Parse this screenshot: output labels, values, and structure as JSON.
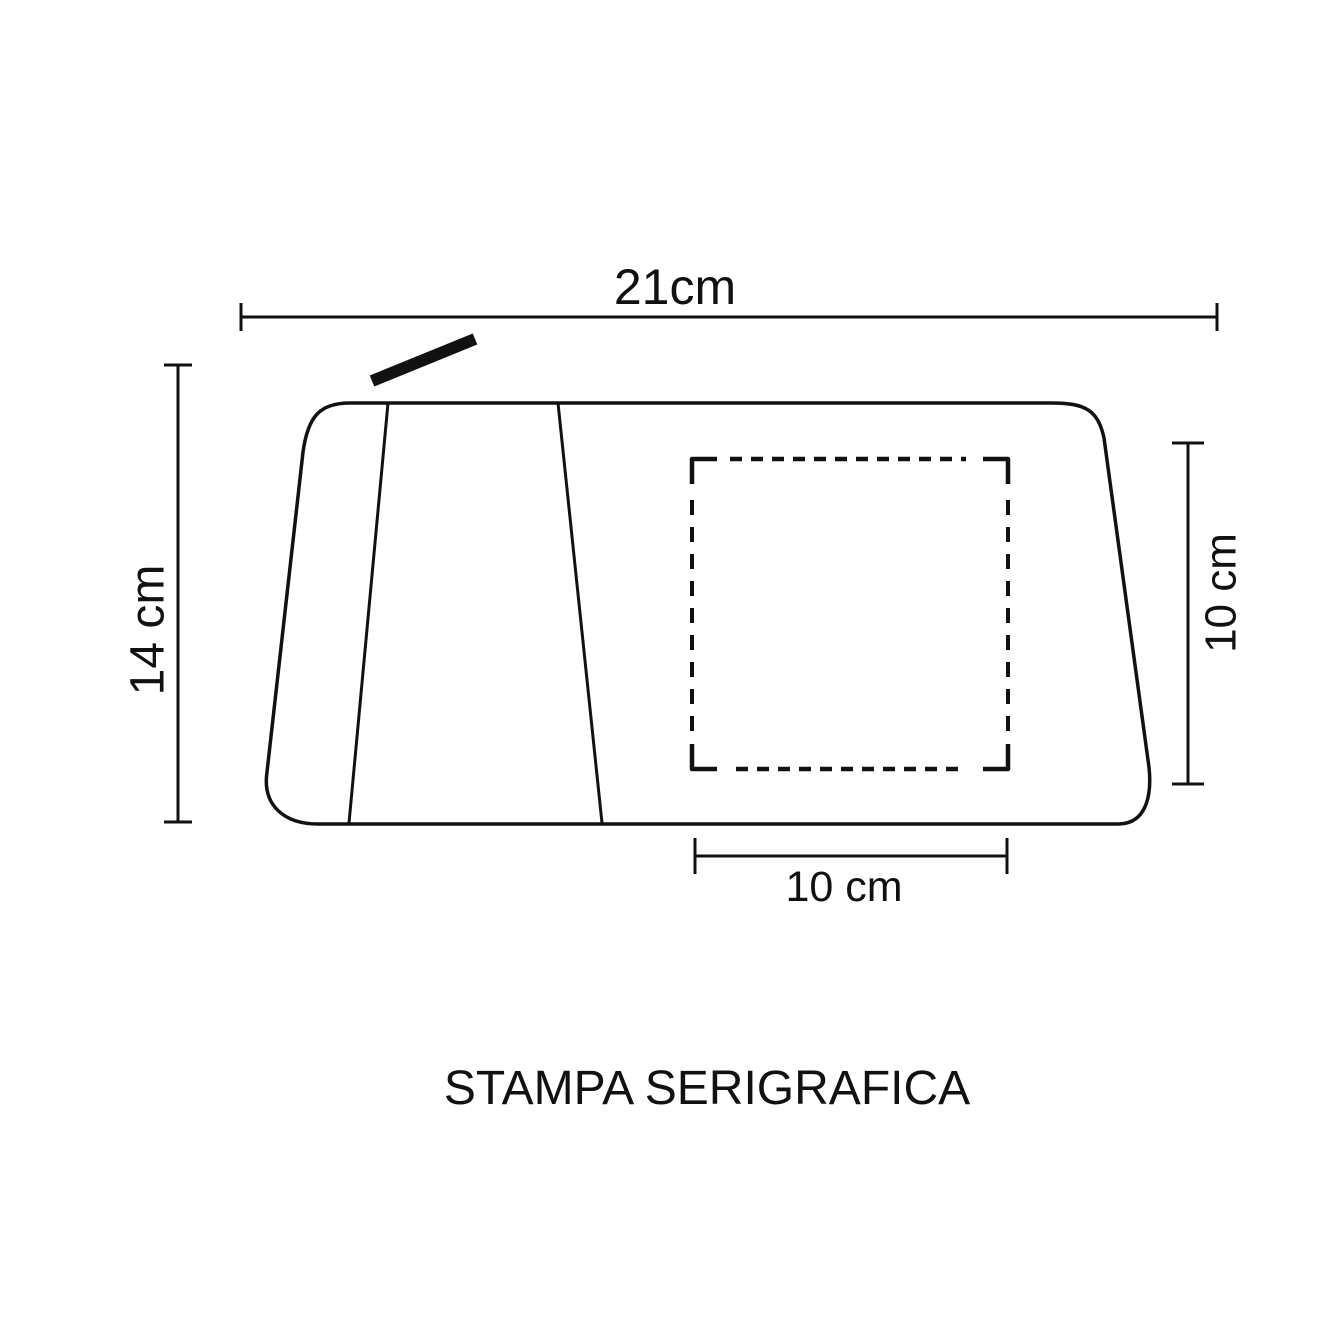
{
  "diagram": {
    "caption": "STAMPA SERIGRAFICA",
    "colors": {
      "ink": "#111111",
      "background": "#ffffff"
    },
    "dimensions": {
      "overall_width": {
        "label": "21cm",
        "side": "top"
      },
      "overall_height": {
        "label": "14 cm",
        "side": "left"
      },
      "print_area_height": {
        "label": "10 cm",
        "side": "right"
      },
      "print_area_width": {
        "label": "10 cm",
        "side": "bottom"
      }
    },
    "marks": {
      "pouch_outline": "rounded-trapezoid-pouch-front",
      "print_area": "dashed-square-with-corner-brackets",
      "zipper_pull": "thick-diagonal-bar"
    }
  }
}
